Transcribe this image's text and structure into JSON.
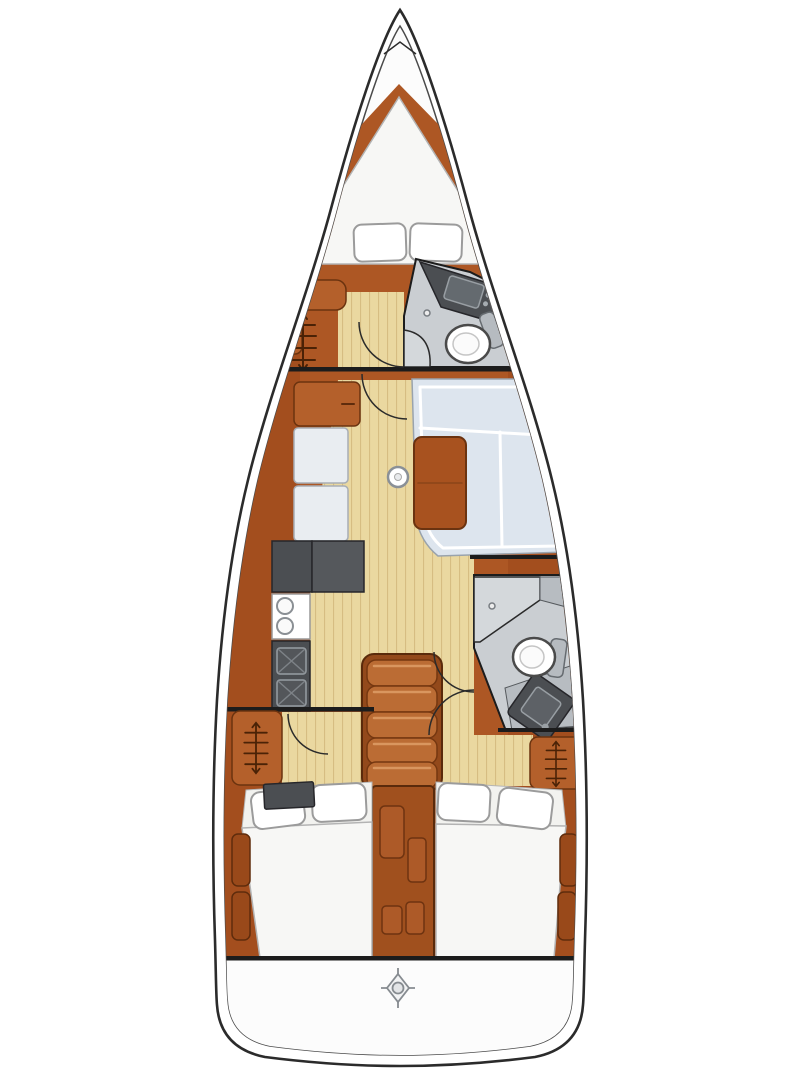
{
  "app": {
    "type": "sailboat-interior-floor-plan",
    "view": "top-down-deck-plan",
    "visible_text": ""
  },
  "colors": {
    "hull_outline": "#2b2b2b",
    "deck_white": "#fcfcfc",
    "wood_base": "#ad5724",
    "wood_dark": "#9a4719",
    "wood_furniture": "#b4602b",
    "wood_trim": "#6b330f",
    "stairs_wood": "#bb6c34",
    "floor_tan": "#ead8a0",
    "floor_stripe": "#d6bd82",
    "counter_dark": "#4b4e52",
    "counter_mid": "#55585c",
    "bath_floor": "#caced2",
    "bath_wall": "#b7bcc1",
    "shower_floor": "#d4d8db",
    "cushion_blue": "#dde5ee",
    "cushion_white": "#e9edf1",
    "mattress_white": "#f7f7f5",
    "pillow_white": "#ffffff",
    "table_wood": "#a8521f",
    "line_black": "#1c1c1c",
    "symbol_brown": "#4a2206"
  },
  "icons": {
    "hanging_locker": "hanger-rail-symbol",
    "helm_marker": "diamond-compass-icon",
    "stove": "two-burner-circles",
    "galley_sink": "square-with-x",
    "toilet": "oval-bowl",
    "door_swing": "quarter-arc"
  },
  "rooms": [
    "v-berth-forward-cabin",
    "forward-head",
    "salon-with-u-settee-and-table",
    "galley",
    "aft-head",
    "companionway-stairs",
    "port-aft-cabin",
    "starboard-aft-cabin",
    "stern-cockpit"
  ]
}
